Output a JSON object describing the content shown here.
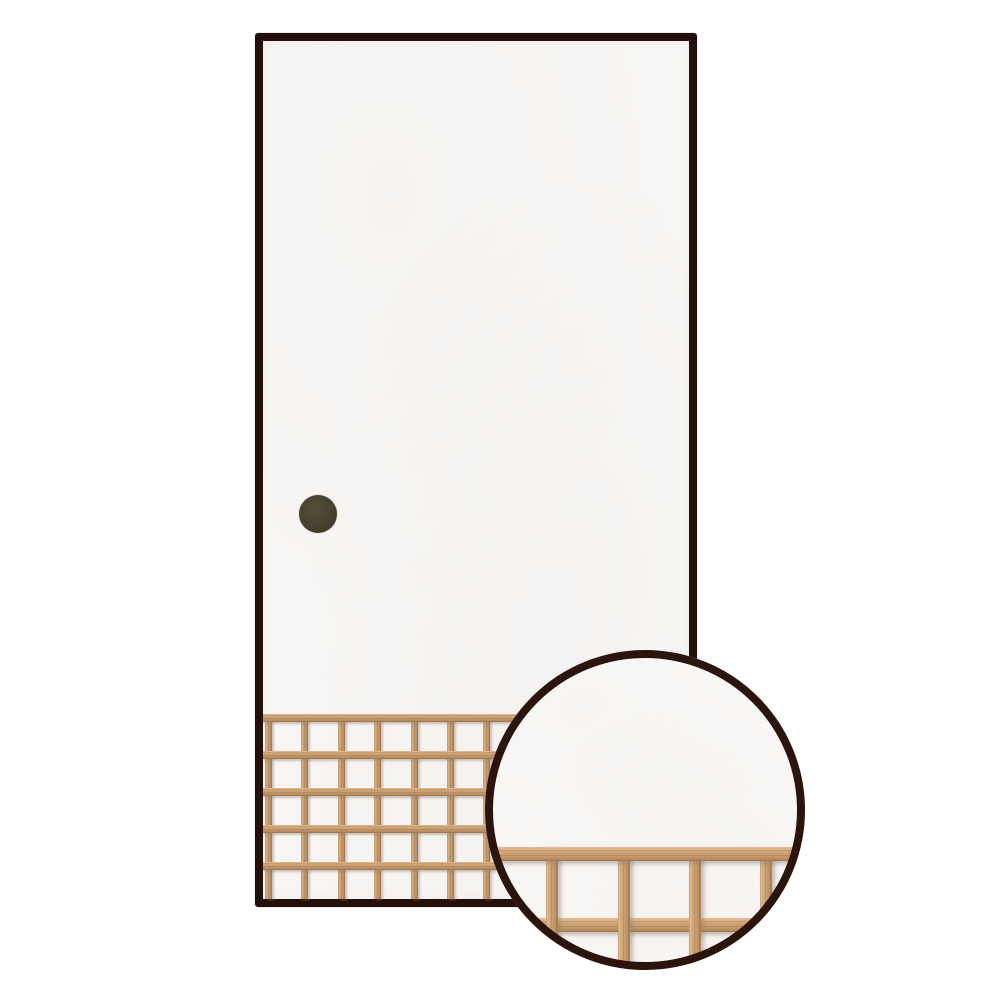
{
  "scene": {
    "canvas": {
      "w": 1000,
      "h": 1000,
      "background": "#ffffff"
    },
    "door": {
      "x": 255,
      "y": 33,
      "w": 442,
      "h": 874,
      "frame_width": 8,
      "frame_color": "#24100a",
      "paper_color": "#f8f6f4",
      "corner_radius": 3
    },
    "handle": {
      "cx": 318,
      "cy": 514,
      "d": 38,
      "color": "#45402e"
    },
    "lattice": {
      "left": 0,
      "top": 673,
      "w": 426,
      "h": 185,
      "wood_base": "#cda271",
      "wood_light": "#dcb68c",
      "wood_dark": "#aa7f52",
      "v_bars": {
        "count": 12,
        "start": 2,
        "pitch": 36.4,
        "width": 7
      },
      "h_bars": {
        "count": 5,
        "start": 0,
        "pitch": 37,
        "height": 8
      }
    },
    "inset": {
      "x": 485,
      "y": 650,
      "d": 320,
      "ring_width": 8,
      "ring_color": "#2b140c",
      "paper_color": "#faf8f6",
      "wood_base": "#d0a776",
      "h_bars": [
        {
          "y": 197,
          "h": 14
        },
        {
          "y": 268,
          "h": 14
        }
      ],
      "v_bars": {
        "count": 6,
        "start": -10,
        "pitch": 71.3,
        "width": 12,
        "top": 197
      }
    }
  }
}
